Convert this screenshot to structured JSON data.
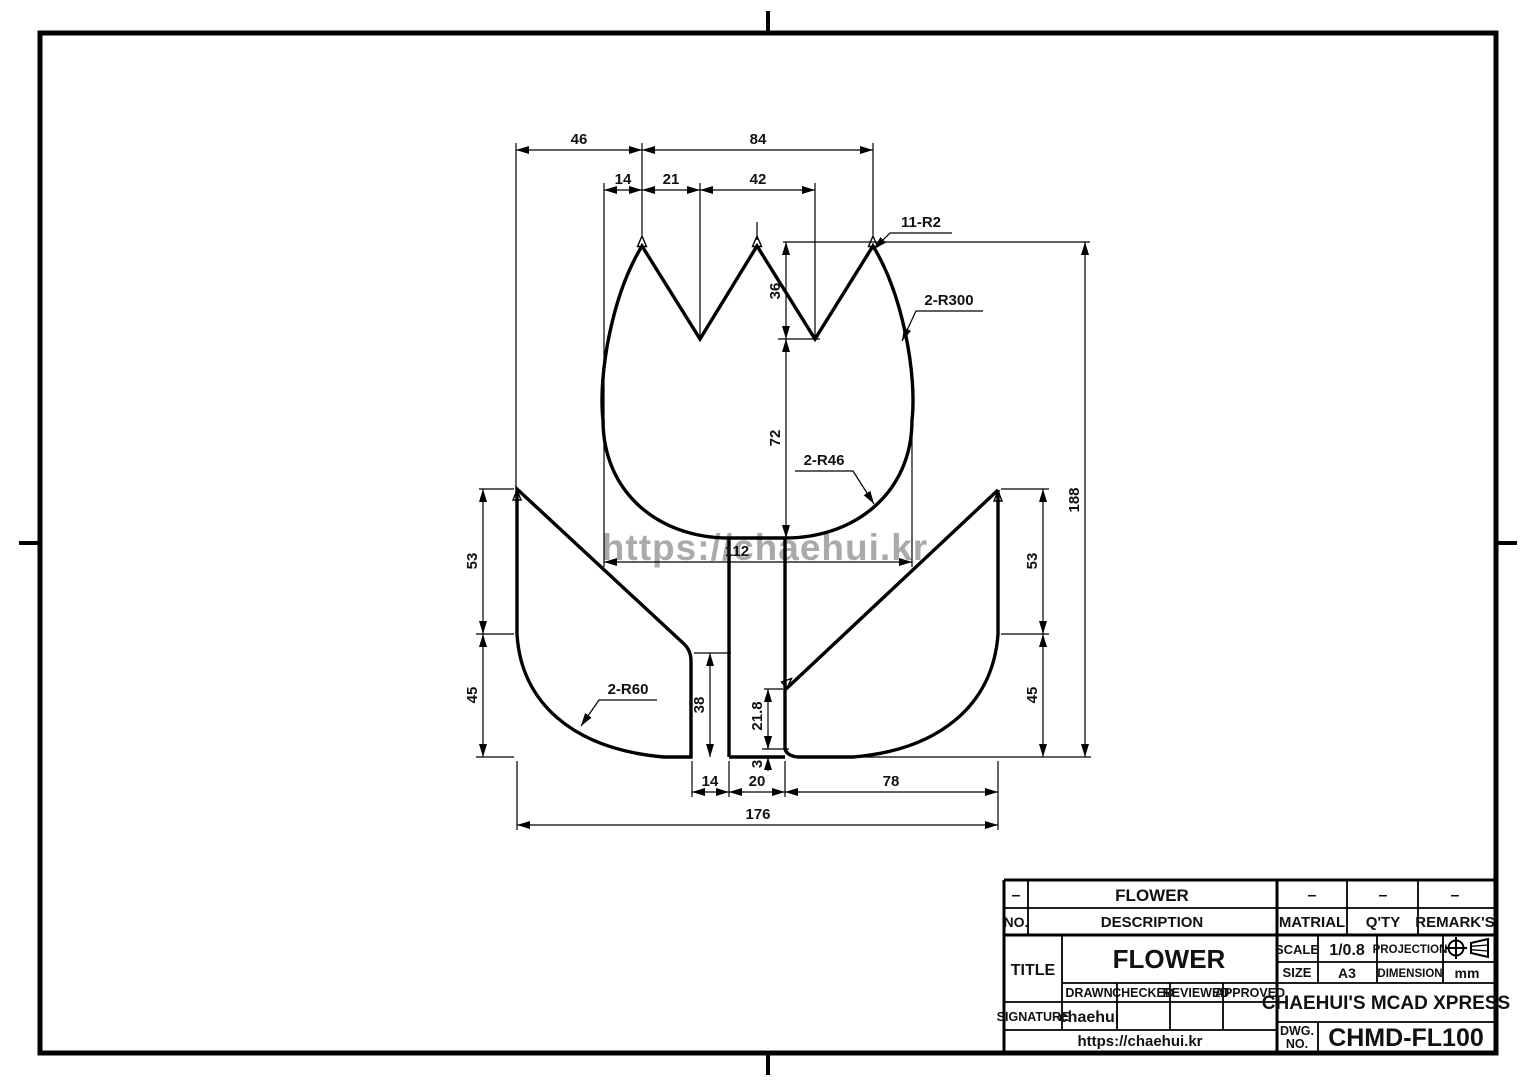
{
  "watermark": "https://chaehui.kr",
  "dims": {
    "w46": "46",
    "w84": "84",
    "w14": "14",
    "w21": "21",
    "w42": "42",
    "h36": "36",
    "h72": "72",
    "w112": "112",
    "h188": "188",
    "l53": "53",
    "l45": "45",
    "r53": "53",
    "r45": "45",
    "h38": "38",
    "h218": "21.8",
    "h3": "3",
    "b14": "14",
    "b20": "20",
    "b78": "78",
    "b176": "176"
  },
  "labels": {
    "r2": "11-R2",
    "r300": "2-R300",
    "r46": "2-R46",
    "r60": "2-R60"
  },
  "title_block": {
    "row_top": {
      "c1": "–",
      "c2": "FLOWER",
      "c3": "–",
      "c4": "–",
      "c5": "–"
    },
    "row_head": {
      "no": "NO.",
      "description": "DESCRIPTION",
      "matrial": "MATRIAL",
      "qty": "Q'TY",
      "remarks": "REMARK'S"
    },
    "title_label": "TITLE",
    "title_value": "FLOWER",
    "scale_label": "SCALE",
    "scale_value": "1/0.8",
    "projection_label": "PROJECTION",
    "size_label": "SIZE",
    "size_value": "A3",
    "dimension_label": "DIMENSION",
    "dimension_value": "mm",
    "drawn": "DRAWN",
    "checked": "CHECKED",
    "reviewed": "REVIEWED",
    "approved": "APPROVED",
    "signature_label": "SIGNATURE",
    "signature_value": "chaehui",
    "site": "https://chaehui.kr",
    "company": "CHAEHUI'S MCAD XPRESS",
    "dwg_label_1": "DWG.",
    "dwg_label_2": "NO.",
    "dwg_no": "CHMD-FL100"
  }
}
